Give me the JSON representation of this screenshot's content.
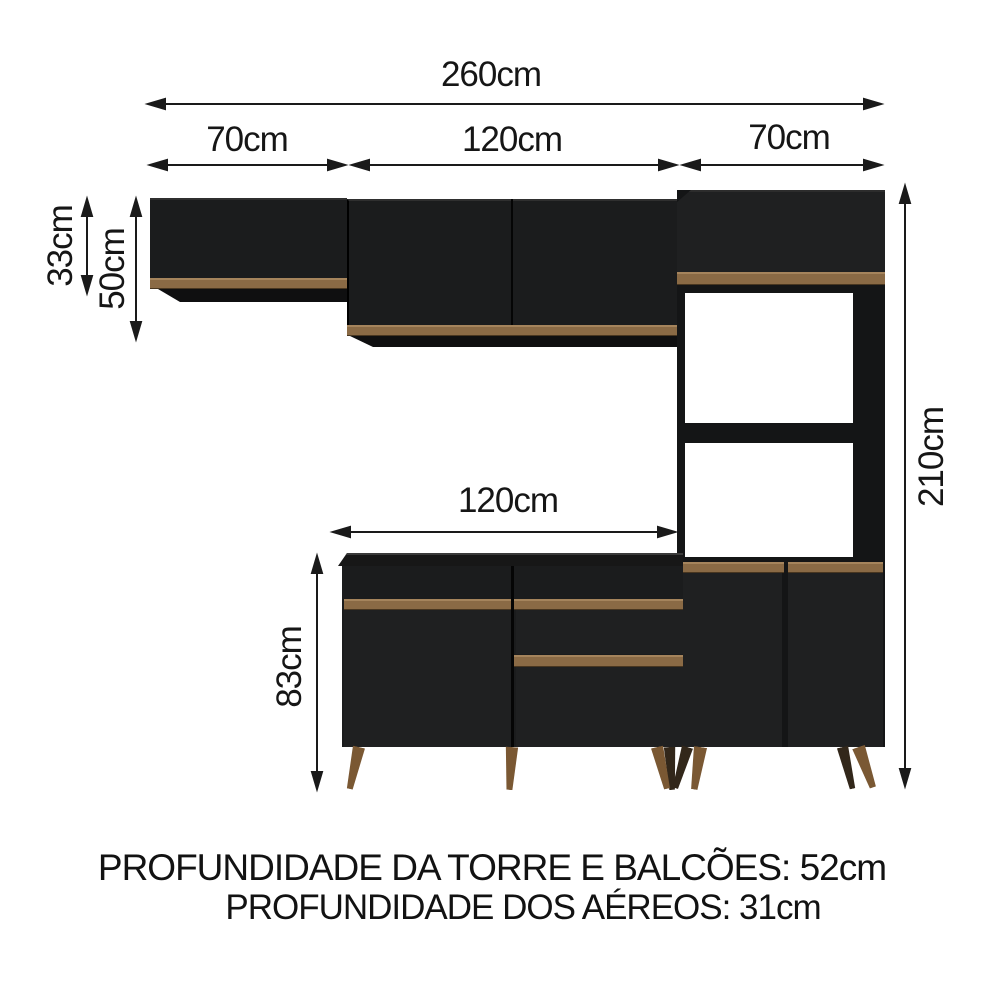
{
  "diagram": {
    "dims": {
      "total_width": "260cm",
      "section_left": "70cm",
      "section_middle": "120cm",
      "section_right": "70cm",
      "upper_left_height": "33cm",
      "upper_middle_height": "50cm",
      "niche_upper_height": "47cm",
      "niche_lower_height": "41cm",
      "tower_height": "210cm",
      "base_width": "120cm",
      "base_height": "83cm"
    },
    "footer": {
      "line1": "PROFUNDIDADE DA TORRE E BALCÕES: 52cm",
      "line2": "PROFUNDIDADE DOS AÉREOS: 31cm"
    },
    "colors": {
      "cabinet_black": "#1b1c1d",
      "wood_trim": "#8a6a45",
      "wood_leg": "#7a5833",
      "arrow": "#1a1a1a",
      "background": "#ffffff"
    }
  }
}
